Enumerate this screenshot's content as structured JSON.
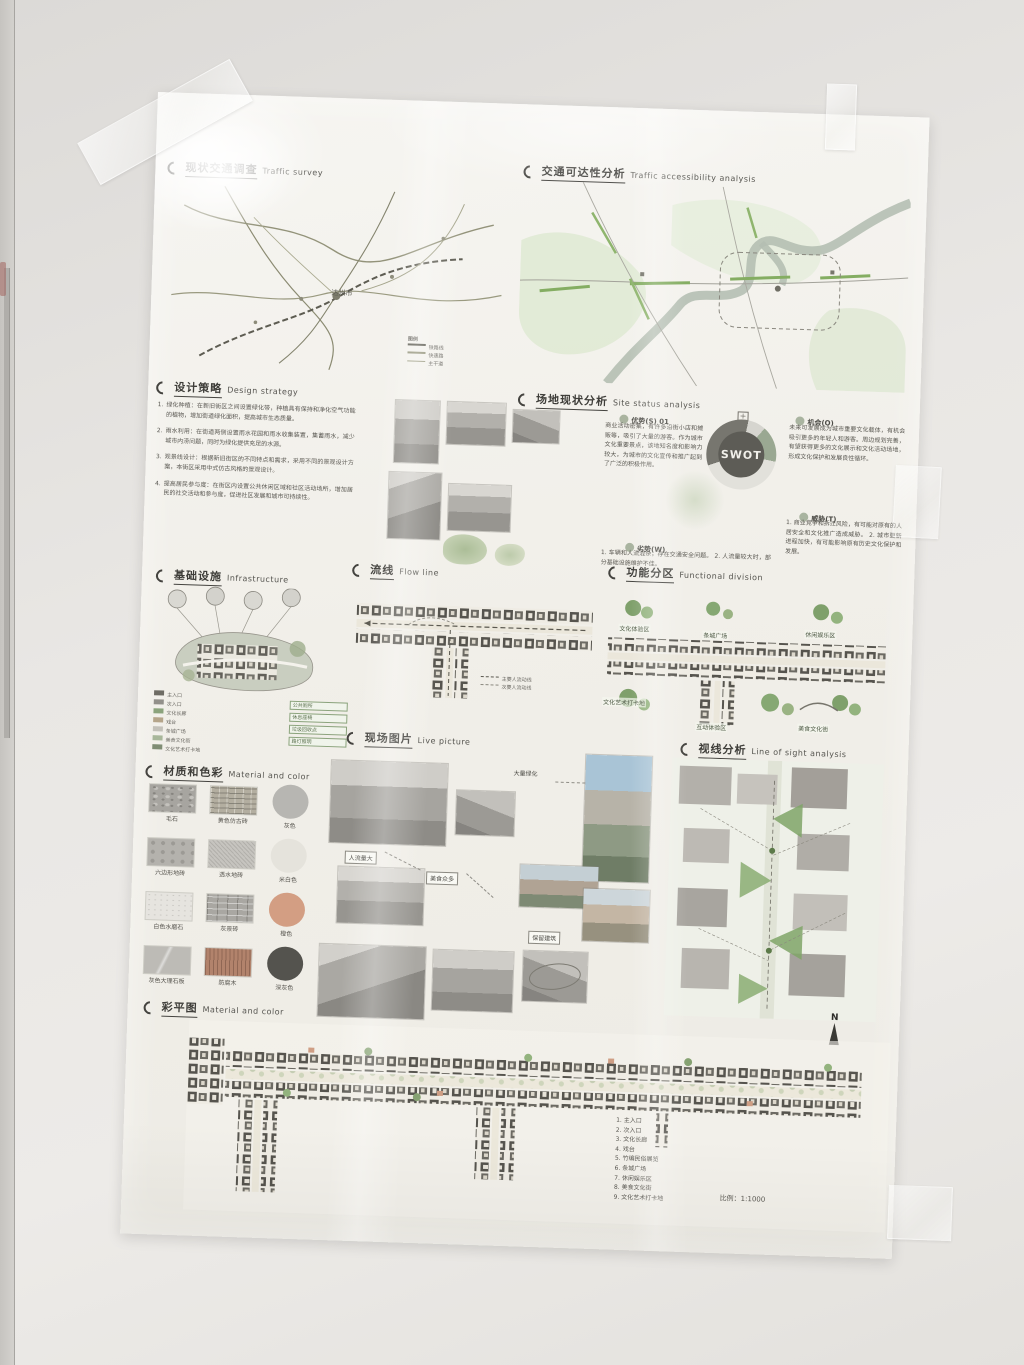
{
  "poster": {
    "traffic_survey": {
      "title_zh": "现状交通调查",
      "title_en": "Traffic survey",
      "city_label": "达州市",
      "legend_title": "图例",
      "legend_items": [
        "铁路线",
        "快速路",
        "主干道"
      ]
    },
    "accessibility": {
      "title_zh": "交通可达性分析",
      "title_en": "Traffic accessibility analysis"
    },
    "design_strategy": {
      "title_zh": "设计策略",
      "title_en": "Design strategy",
      "items": [
        {
          "num": "1.",
          "text": "绿化种植：在新旧街区之间设置绿化带，种植具有保持和净化空气功能的植物，增加街道绿化面积，提高城市生态质量。"
        },
        {
          "num": "2.",
          "text": "雨水利用：在街道两侧设置雨水花园和雨水收集装置，集蓄雨水，减少城市内涝问题，同时为绿化提供充足的水源。"
        },
        {
          "num": "3.",
          "text": "观景线设计：根据新旧街区的不同特点和需求，采用不同的景观设计方案，本街区采用中式仿古风格的景观设计。"
        },
        {
          "num": "4.",
          "text": "提高居民参与度：在街区内设置公共休闲区域和社区活动场所，增加居民的社交活动和参与度，促进社区发展和城市可持续性。"
        }
      ]
    },
    "site_status": {
      "title_zh": "场地现状分析",
      "title_en": "Site status analysis",
      "swot_label": "SWOT",
      "strength_label": "优势(S)",
      "strength_num": "01",
      "strength_text": "商业活动密集，有许多沿街小店和摊贩等，吸引了大量的游客。作为城市文化重要景点，该地知名度和影响力较大，为城市的文化宣传和推广起到了广泛的积极作用。",
      "weakness_label": "劣势(W)",
      "weakness_text": "1. 车辆和人流混杂，存在交通安全问题。  2. 人流量较大时，部分基础设施维护不佳。",
      "opportunity_label": "机会(O)",
      "opportunity_text": "未来可发展成为城市重要文化载体，有机会吸引更多的年轻人和游客。周边规划完善，有望获得更多的文化展示和文化活动场地，形成文化保护和发展良性循环。",
      "threat_label": "威胁(T)",
      "threat_text": "1. 商业竞争和拆迁风险，有可能对原有的人居安全和文化推广造成威胁。  2. 城市更新进程加快，有可能影响原有历史文化保护和发展。"
    },
    "infrastructure": {
      "title_zh": "基础设施",
      "title_en": "Infrastructure",
      "legend_left": [
        "主入口",
        "次入口",
        "文化长廊",
        "戏台",
        "条城广场",
        "美食文化街",
        "文化艺术打卡地"
      ],
      "legend_right": [
        "公共厕所",
        "休息座椅",
        "垃圾回收点",
        "路灯照明"
      ]
    },
    "flow_line": {
      "title_zh": "流线",
      "title_en": "Flow line",
      "legend": [
        "主要人流动线",
        "次要人流动线"
      ]
    },
    "functional_division": {
      "title_zh": "功能分区",
      "title_en": "Functional division",
      "zones": [
        "文化体验区",
        "条城广场",
        "休闲娱乐区",
        "文化艺术打卡地",
        "互动体验区",
        "美食文化街"
      ]
    },
    "live_picture": {
      "title_zh": "现场图片",
      "title_en": "Live picture",
      "annotations": [
        "大量绿化",
        "人流量大",
        "美食众多",
        "保留建筑"
      ]
    },
    "sight_analysis": {
      "title_zh": "视线分析",
      "title_en": "Line of sight analysis"
    },
    "material_color": {
      "title_zh": "材质和色彩",
      "title_en": "Material and color",
      "rows": [
        {
          "tex1": "毛石",
          "tex2": "黄色仿古砖",
          "color_label": "灰色",
          "color_hex": "#b7b6b2"
        },
        {
          "tex1": "六边形地砖",
          "tex2": "透水地砖",
          "color_label": "米白色",
          "color_hex": "#e5e3dc"
        },
        {
          "tex1": "白色水磨石",
          "tex2": "灰景砖",
          "color_label": "橙色",
          "color_hex": "#d39e83"
        },
        {
          "tex1": "灰色大理石板",
          "tex2": "防腐木",
          "color_label": "深灰色",
          "color_hex": "#54534e"
        }
      ]
    },
    "color_plan": {
      "title_zh": "彩平图",
      "title_en": "Material and color",
      "north_label": "N",
      "legend": [
        "1. 主入口",
        "2. 次入口",
        "3. 文化长廊",
        "4. 戏台",
        "5. 竹编民俗展览",
        "6. 条城广场",
        "7. 休闲娱乐区",
        "8. 美食文化街",
        "9. 文化艺术打卡地"
      ],
      "scale_text": "比例：1:1000"
    }
  }
}
